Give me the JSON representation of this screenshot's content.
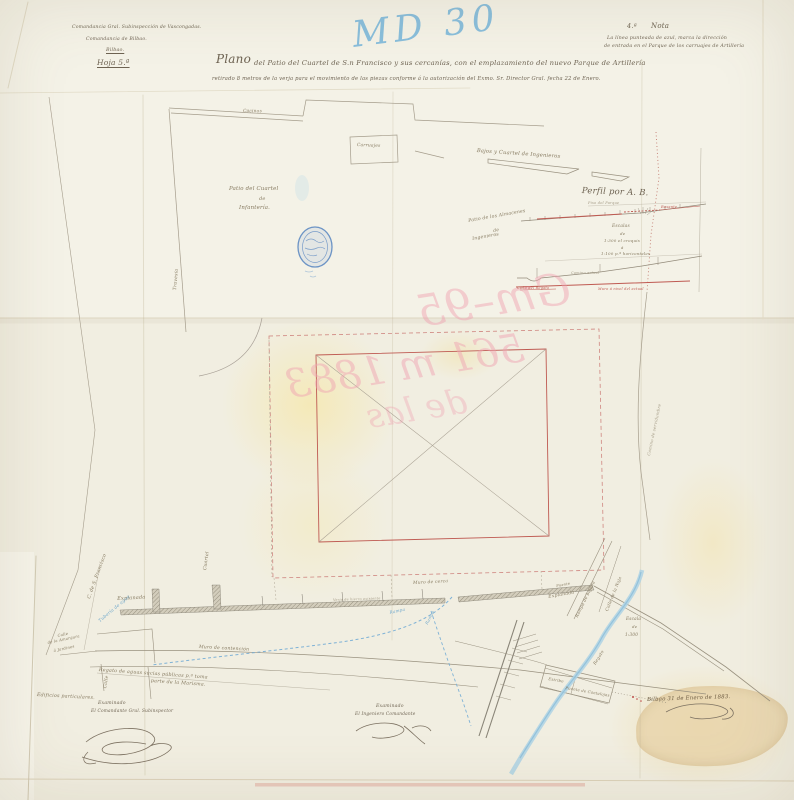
{
  "document": {
    "type": "plano historico",
    "header": {
      "line1": "Comandancia Gral. Subinspección de Vascongadas.",
      "line2": "Comandancia de Bilbao.",
      "line3": "Bilbao.",
      "line4": "Hoja 5.ª"
    },
    "title": {
      "lead": "Plano",
      "rest": "del Patio del Cuartel de S.n Francisco y sus cercanías, con el emplazamiento del nuevo Parque de Artillería",
      "subtitle": "retirado 8 metros de la verja para el movimiento de las piezas conforme á la autorización del Exmo. Sr. Director Gral. fecha 22 de Enero."
    },
    "nota": {
      "numero": "4.ª",
      "titulo": "Nota",
      "lineas": [
        "La línea punteada de azul, marca la dirección",
        "de entrada en el Parque de los carruajes de Artillería"
      ]
    },
    "annotations": {
      "blue_pencil": "MD 30",
      "red_pencil_mirrored": [
        "Gm–95",
        "561 m 1883",
        "de las"
      ]
    },
    "perfil": {
      "titulo": "Perfil por A. B.",
      "escalas": [
        "Escalas",
        "de",
        "1:300 el croquis",
        "á",
        "1:100 p.ª horizontales"
      ],
      "piso": "Piso del Parque",
      "rasante": "Rasante",
      "camino_actual": "Camino actual",
      "cano_regato": "Caño del Regato",
      "muro_nivel": "Muro á nivel del actual"
    },
    "escala_plano": [
      "Escala",
      "de",
      "1:300"
    ],
    "map_labels": {
      "cocinas": "Cocinas",
      "carruajes": "Carruajes",
      "patio_cuartel": [
        "Patio del Cuartel",
        "de",
        "Infantería."
      ],
      "travesia": "Travesía",
      "bajos": "Bajos y Cuartel de Ingenieros",
      "patio_almacenes": [
        "Patio de los Almacenes",
        "de",
        "Ingenieros"
      ],
      "camino_servidumbre": "Camino de servidumbre",
      "muro_cerca": "Muro de cerca",
      "verja": "Verja de hierro existente",
      "explanada1": "Explanada",
      "explanada2": "Explanada",
      "puente": "Puente",
      "cuartel": "Cuartel",
      "calle_san_francisco": "C. de S. Francisco",
      "tuberia": "Tubería de agua",
      "calle": "Calle",
      "calle_amargura": [
        "Calle",
        "de la Amargura",
        "á Jardines"
      ],
      "muro_contencion": "Muro de contención",
      "regato_aguas": [
        "Regato de aguas sucias públicas p.ª toma",
        "parte de la Marisma."
      ],
      "edificios": "Edificios particulares.",
      "rampa1": "Rampa",
      "rampa2": "Rampa",
      "rampa_bajada": "Rampa de bajada",
      "calle_naja": "Calle de la Naja",
      "regato": "Regato",
      "estribo": "Estribo",
      "puente_cantalojas": "Puente de Cantalojas"
    },
    "signatures": {
      "left": {
        "l1": "Examinado",
        "l2": "El Comandante Gral. Subinspector"
      },
      "right": {
        "l1": "Examinado",
        "l2": "El Ingeniero Comandante"
      },
      "fecha": "Bilbao 31 de Enero de 1883."
    },
    "colors": {
      "paper": "#f1eee1",
      "ink": "#6e6352",
      "line_grey": "#a29a89",
      "red": "#bf5a52",
      "pink_pencil": "#f0a3b2",
      "blue": "#7fb2d6",
      "stream": "#aed2e4",
      "tan_patch": "#e9d6ae"
    }
  }
}
